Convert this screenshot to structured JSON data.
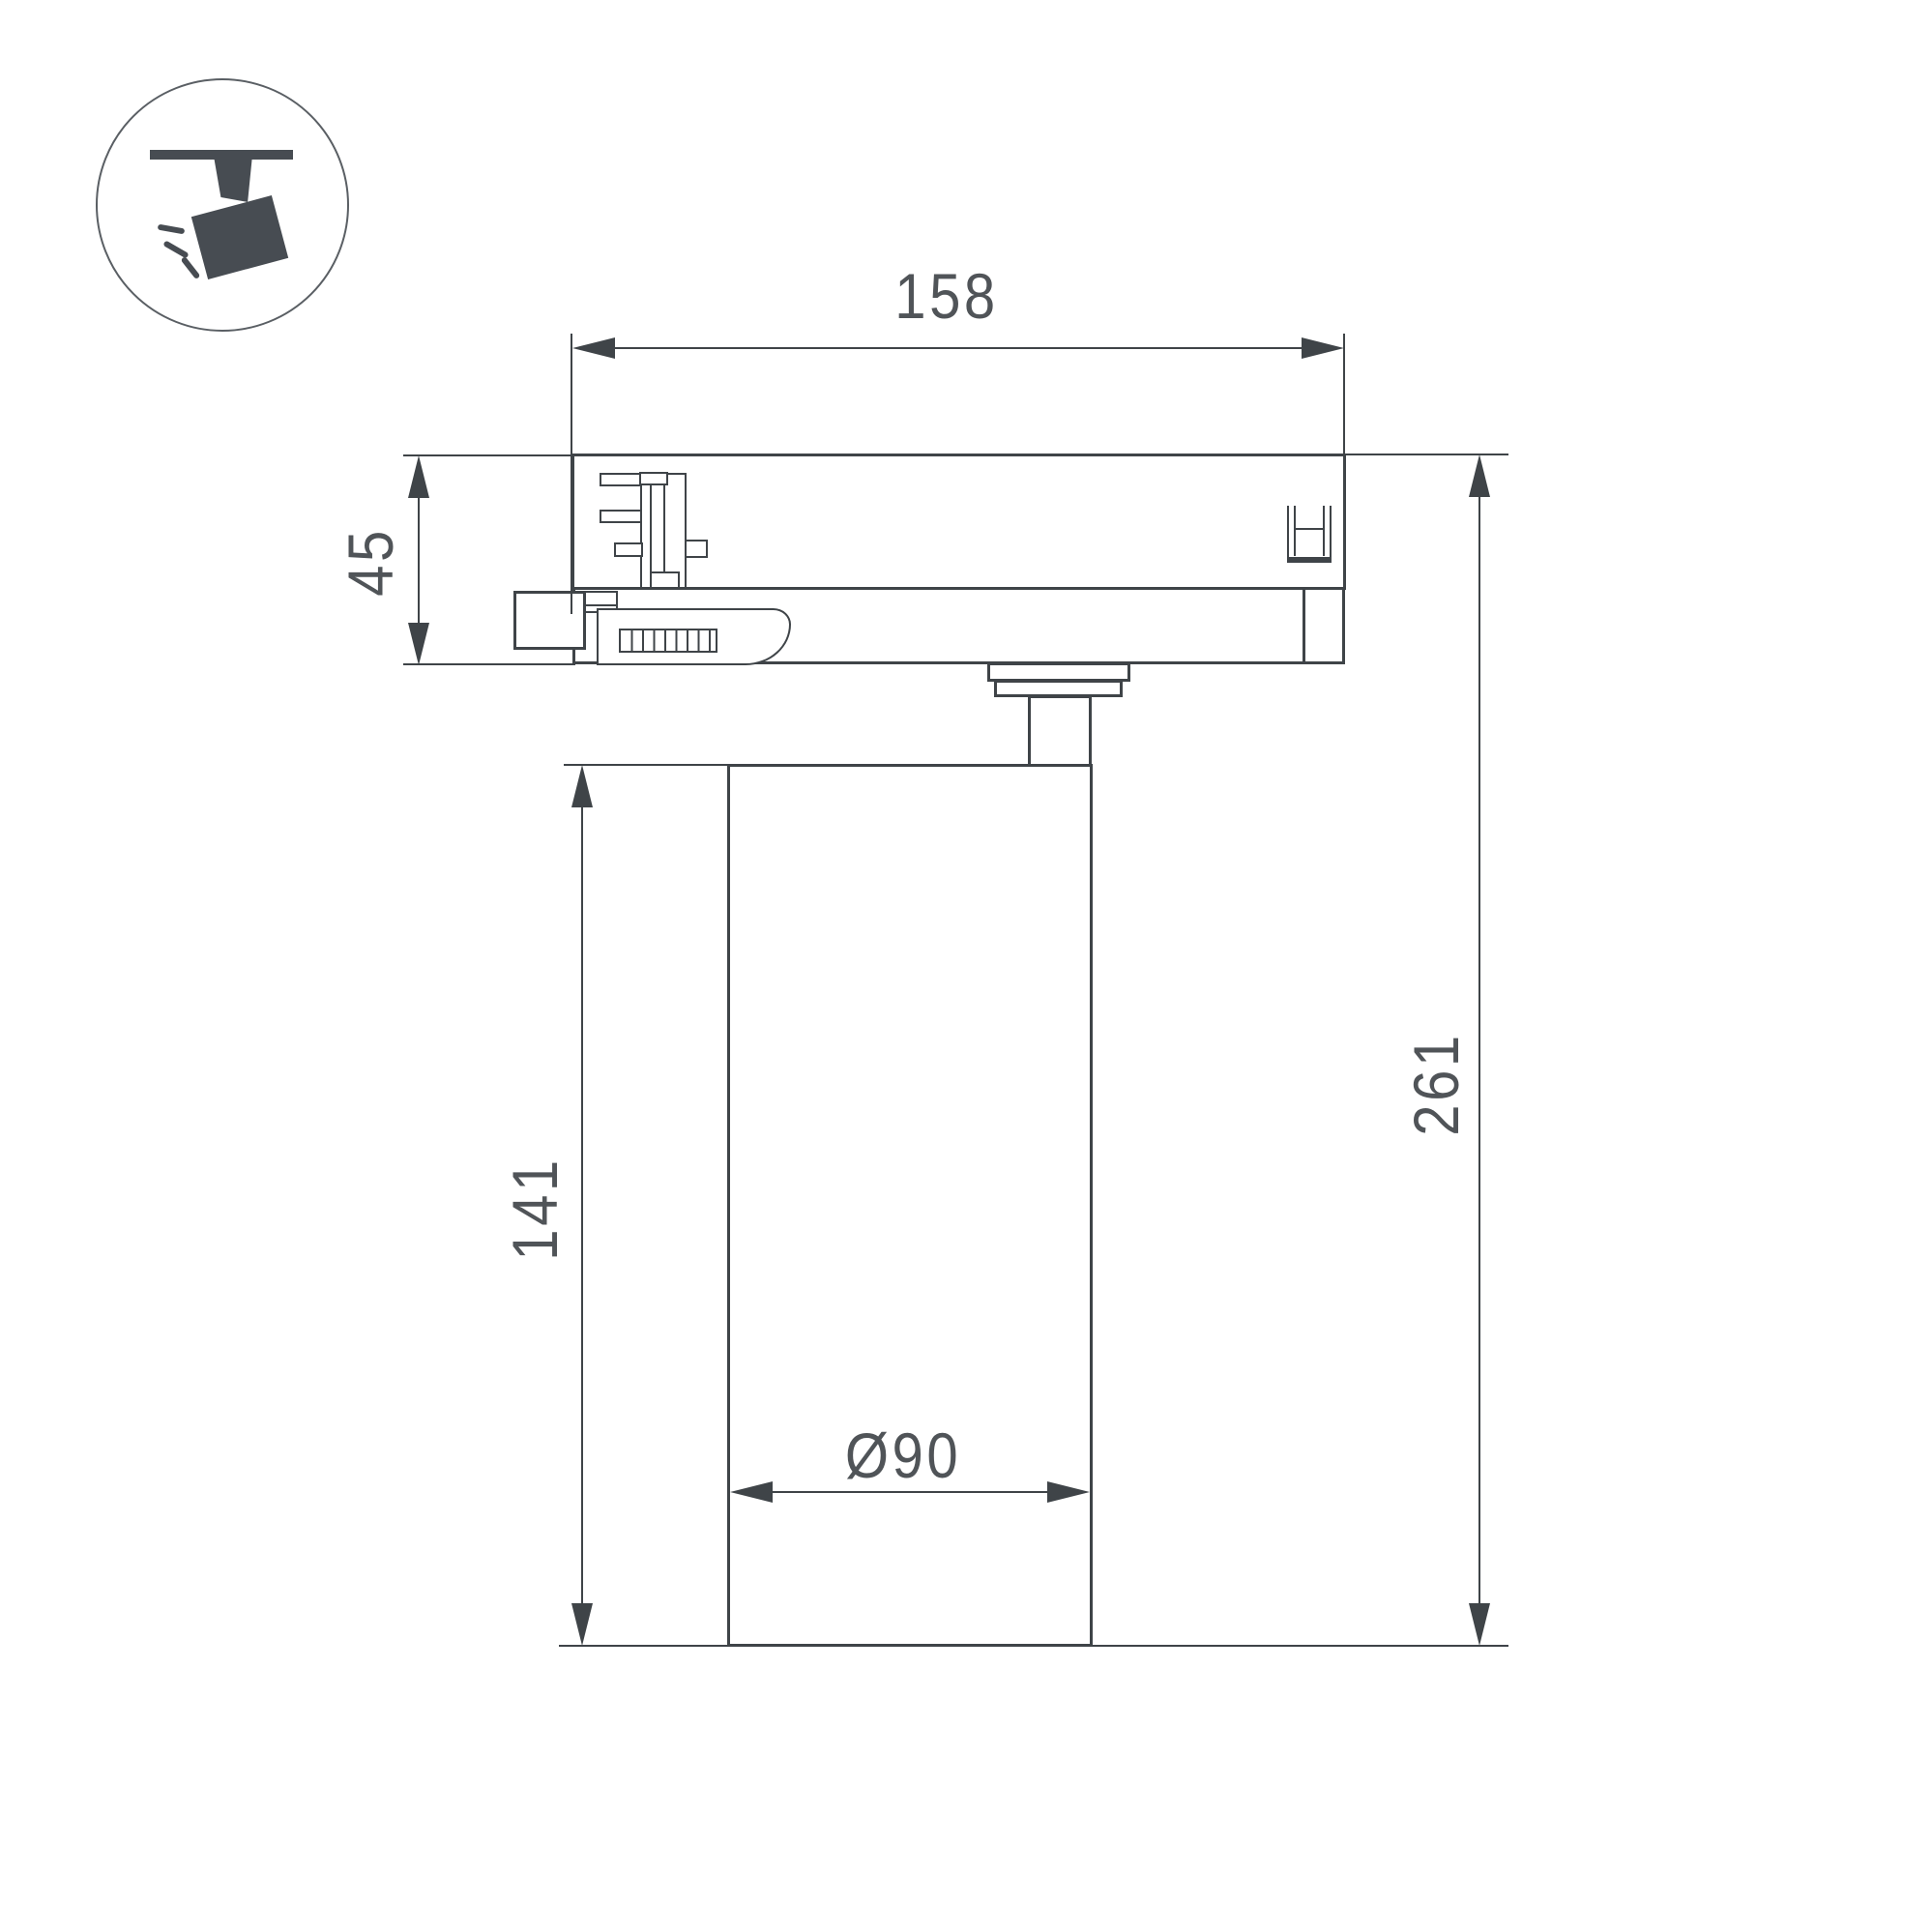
{
  "page": {
    "background": "#ffffff",
    "type": "technical-dimension-drawing"
  },
  "icon": {
    "name": "track-spotlight-icon"
  },
  "dimensions": {
    "adapter_width": "158",
    "adapter_height": "45",
    "body_height": "141",
    "total_height": "261",
    "body_diameter": "Ø90"
  },
  "colors": {
    "line": "#3f4448",
    "dimension_text": "#505458",
    "icon_fill": "#474c52",
    "background": "#ffffff"
  }
}
